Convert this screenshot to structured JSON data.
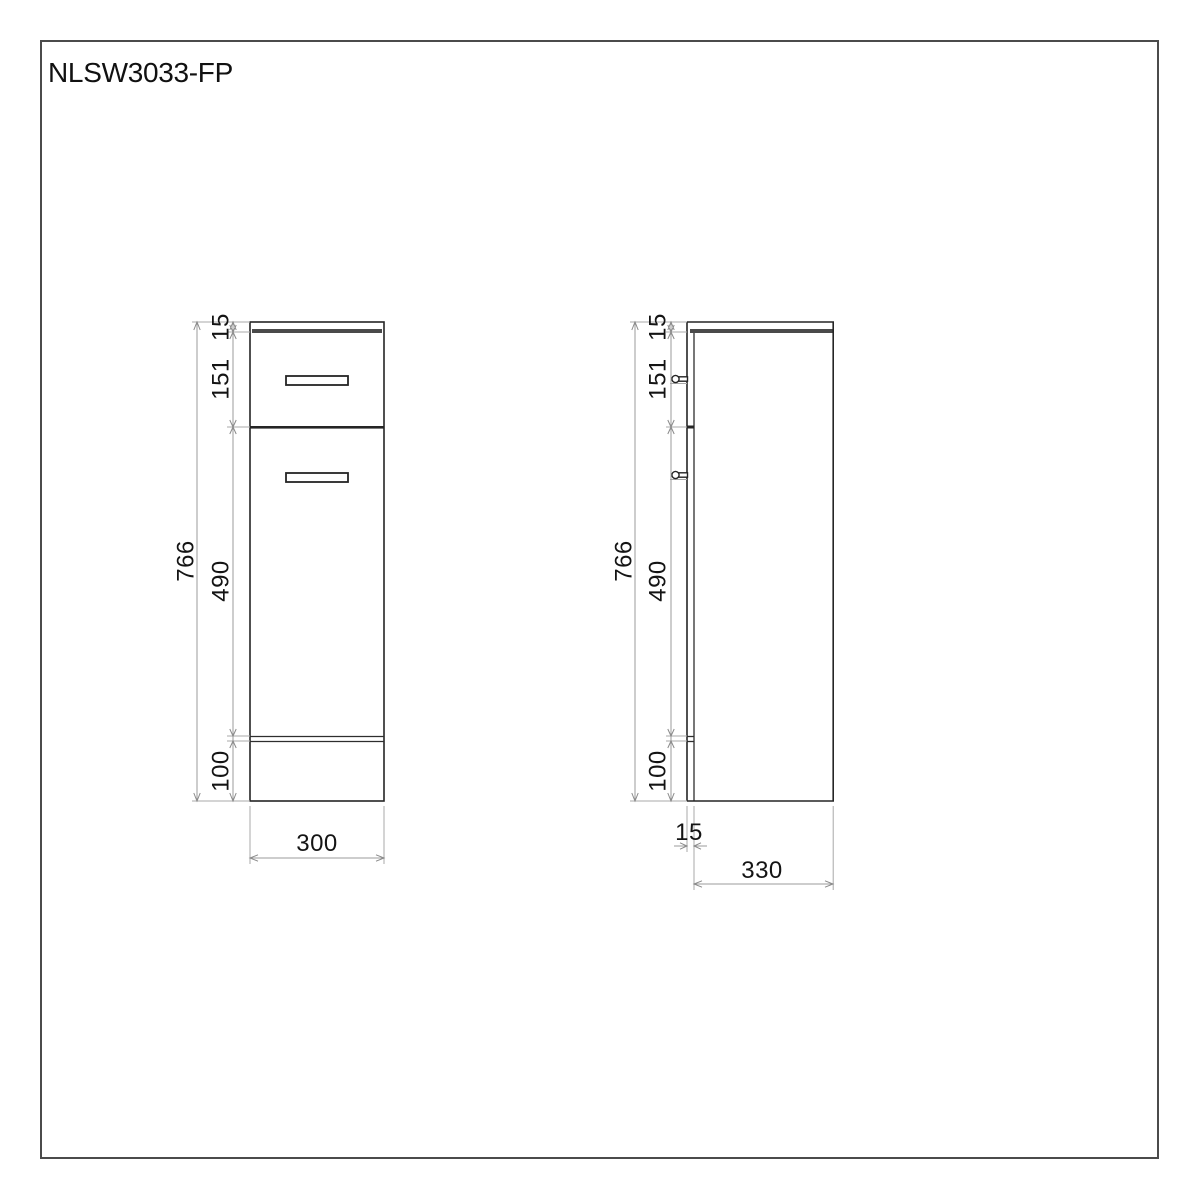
{
  "title": "NLSW3033-FP",
  "colors": {
    "background": "#ffffff",
    "object_line": "#252525",
    "thick_band": "#4a4a4a",
    "dimension_line": "#9b9b9b",
    "text": "#141414",
    "page_border": "#4b4b4b"
  },
  "front_view": {
    "overall_height": "766",
    "segments": {
      "top_panel": "15",
      "drawer": "151",
      "door": "490",
      "plinth": "100"
    },
    "width": "300"
  },
  "side_view": {
    "overall_height": "766",
    "segments": {
      "top_panel": "15",
      "drawer": "151",
      "door": "490",
      "plinth": "100"
    },
    "front_panel_thickness": "15",
    "depth": "330"
  }
}
